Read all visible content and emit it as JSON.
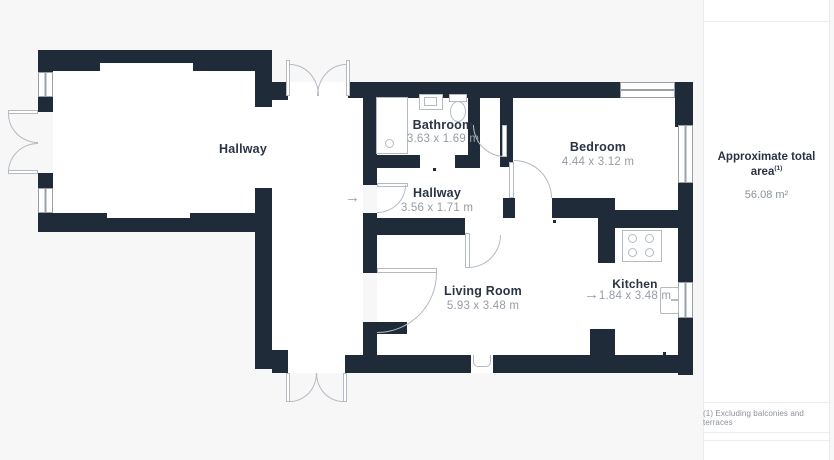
{
  "plan": {
    "rooms": [
      {
        "name": "Hallway",
        "dims": ""
      },
      {
        "name": "Bathroom",
        "dims": "3.63 x 1.69 m"
      },
      {
        "name": "Hallway",
        "dims": "3.56 x 1.71 m"
      },
      {
        "name": "Bedroom",
        "dims": "4.44 x 3.12 m"
      },
      {
        "name": "Living Room",
        "dims": "5.93 x 3.48 m"
      },
      {
        "name": "Kitchen",
        "dims": "1.84 x 3.48 m"
      }
    ],
    "entry_arrow": "→",
    "kitchen_arrow": "→",
    "colors": {
      "wall": "#202b3a",
      "fix": "#b4bac2",
      "label": "#2a3444",
      "dims": "#969ca6"
    }
  },
  "sidebar": {
    "total_area_label": "Approximate total area",
    "total_area_superscript": "(1)",
    "total_area_value": "56.08 m²",
    "footnote": "(1) Excluding balconies and terraces"
  }
}
